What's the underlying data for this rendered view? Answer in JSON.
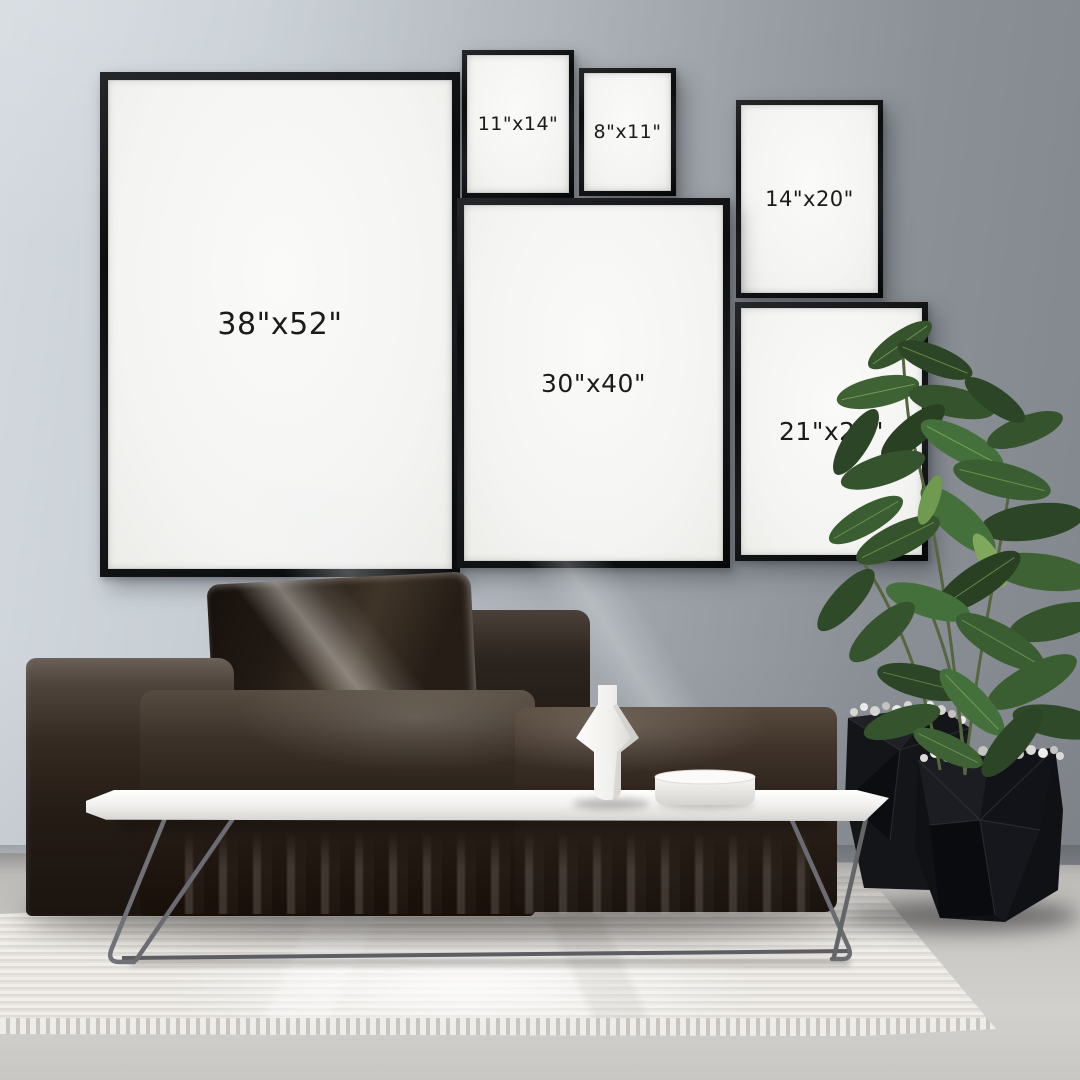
{
  "frames": [
    {
      "label": "38\"x52\""
    },
    {
      "label": "11\"x14\""
    },
    {
      "label": "8\"x11\""
    },
    {
      "label": "14\"x20\""
    },
    {
      "label": "30\"x40\""
    },
    {
      "label": "21\"x28\""
    }
  ],
  "colors": {
    "wall_light": "#d3d9df",
    "wall_dark": "#81868c",
    "frame_black": "#0f1013",
    "matte_white": "#f6f6f4",
    "sofa_brown_black": "#1d1510",
    "table_white": "#f4f3f1",
    "rug_white": "#eae7e2",
    "floor_concrete": "#c2c0bd",
    "leaf_green": "#3a5e31",
    "planter_black": "#121317"
  }
}
